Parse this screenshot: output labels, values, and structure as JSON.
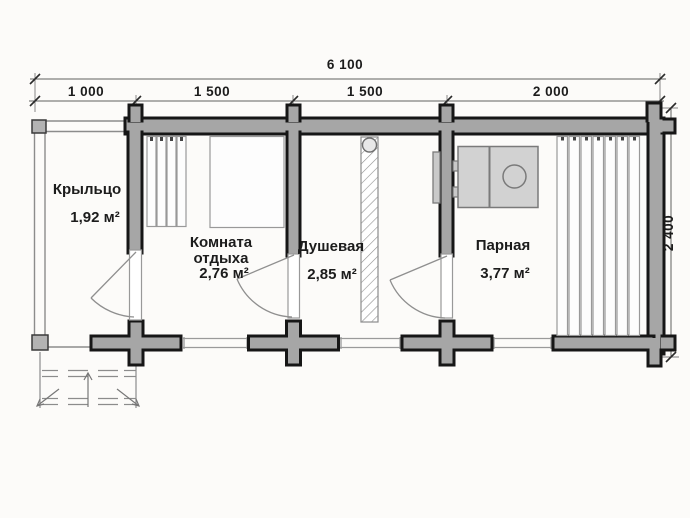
{
  "plan": {
    "type": "bathhouse floor plan",
    "colors": {
      "wall_fill": "#a6a6a6",
      "wall_outline": "#161616",
      "stove_fill": "#d2d2d2",
      "background": "#fcfbf9"
    }
  },
  "dimensions": {
    "total_width": "6 100",
    "segments": [
      "1 000",
      "1 500",
      "1 500",
      "2 000"
    ],
    "depth": "2 400"
  },
  "rooms": [
    {
      "name": "Крыльцо",
      "area": "1,92 м²"
    },
    {
      "name": "Комната отдыха",
      "area": "2,76 м²"
    },
    {
      "name": "Душевая",
      "area": "2,85 м²"
    },
    {
      "name": "Парная",
      "area": "3,77 м²"
    }
  ]
}
